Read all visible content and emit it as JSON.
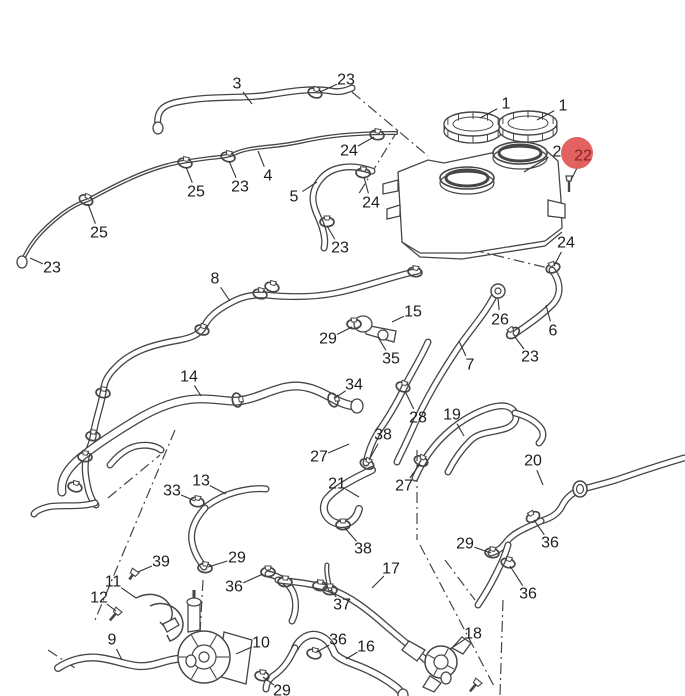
{
  "diagram": {
    "description": "exploded-parts-diagram-cooling-hoses",
    "background": "#ffffff",
    "line_color": "#464646",
    "label_color": "#1c1c1c",
    "highlight": {
      "fill": "#e05a5a",
      "text_color": "#8a1f1f",
      "radius": 16
    },
    "callouts": [
      {
        "label": "3",
        "x": 237,
        "y": 84,
        "tx": 252,
        "ty": 104
      },
      {
        "label": "23",
        "x": 346,
        "y": 80,
        "tx": 320,
        "ty": 92
      },
      {
        "label": "1",
        "x": 506,
        "y": 104,
        "tx": 480,
        "ty": 118
      },
      {
        "label": "1",
        "x": 563,
        "y": 106,
        "tx": 537,
        "ty": 120
      },
      {
        "label": "2",
        "x": 557,
        "y": 152,
        "tx": 524,
        "ty": 172
      },
      {
        "label": "22",
        "x": 583,
        "y": 156,
        "tx": 571,
        "ty": 180,
        "highlighted": true
      },
      {
        "label": "24",
        "x": 349,
        "y": 151,
        "tx": 374,
        "ty": 137
      },
      {
        "label": "25",
        "x": 196,
        "y": 192,
        "tx": 186,
        "ty": 167
      },
      {
        "label": "23",
        "x": 240,
        "y": 187,
        "tx": 229,
        "ty": 161
      },
      {
        "label": "4",
        "x": 268,
        "y": 176,
        "tx": 258,
        "ty": 151
      },
      {
        "label": "5",
        "x": 294,
        "y": 197,
        "tx": 317,
        "ty": 182
      },
      {
        "label": "24",
        "x": 371,
        "y": 203,
        "tx": 364,
        "ty": 177
      },
      {
        "label": "23",
        "x": 340,
        "y": 248,
        "tx": 327,
        "ty": 226
      },
      {
        "label": "25",
        "x": 99,
        "y": 233,
        "tx": 88,
        "ty": 204
      },
      {
        "label": "23",
        "x": 52,
        "y": 268,
        "tx": 30,
        "ty": 258
      },
      {
        "label": "24",
        "x": 566,
        "y": 243,
        "tx": 554,
        "ty": 266
      },
      {
        "label": "8",
        "x": 215,
        "y": 279,
        "tx": 230,
        "ty": 301
      },
      {
        "label": "26",
        "x": 500,
        "y": 320,
        "tx": 498,
        "ty": 298
      },
      {
        "label": "6",
        "x": 553,
        "y": 331,
        "tx": 546,
        "ty": 305
      },
      {
        "label": "23",
        "x": 530,
        "y": 357,
        "tx": 515,
        "ty": 337
      },
      {
        "label": "15",
        "x": 413,
        "y": 312,
        "tx": 392,
        "ty": 322
      },
      {
        "label": "29",
        "x": 328,
        "y": 339,
        "tx": 352,
        "ty": 327
      },
      {
        "label": "35",
        "x": 391,
        "y": 359,
        "tx": 378,
        "ty": 337
      },
      {
        "label": "7",
        "x": 470,
        "y": 365,
        "tx": 459,
        "ty": 341
      },
      {
        "label": "14",
        "x": 189,
        "y": 377,
        "tx": 201,
        "ty": 396
      },
      {
        "label": "34",
        "x": 354,
        "y": 385,
        "tx": 335,
        "ty": 398
      },
      {
        "label": "28",
        "x": 418,
        "y": 418,
        "tx": 405,
        "ty": 391
      },
      {
        "label": "38",
        "x": 383,
        "y": 435,
        "tx": 369,
        "ty": 460
      },
      {
        "label": "19",
        "x": 452,
        "y": 415,
        "tx": 464,
        "ty": 436
      },
      {
        "label": "27",
        "x": 319,
        "y": 457,
        "tx": 349,
        "ty": 444
      },
      {
        "label": "21",
        "x": 337,
        "y": 484,
        "tx": 359,
        "ty": 497
      },
      {
        "label": "27",
        "x": 404,
        "y": 486,
        "tx": 420,
        "ty": 464
      },
      {
        "label": "20",
        "x": 533,
        "y": 461,
        "tx": 543,
        "ty": 485
      },
      {
        "label": "36",
        "x": 550,
        "y": 543,
        "tx": 534,
        "ty": 520
      },
      {
        "label": "29",
        "x": 465,
        "y": 544,
        "tx": 491,
        "ty": 553
      },
      {
        "label": "36",
        "x": 528,
        "y": 594,
        "tx": 510,
        "ty": 566
      },
      {
        "label": "38",
        "x": 363,
        "y": 549,
        "tx": 345,
        "ty": 528
      },
      {
        "label": "17",
        "x": 391,
        "y": 569,
        "tx": 372,
        "ty": 588
      },
      {
        "label": "33",
        "x": 172,
        "y": 491,
        "tx": 195,
        "ty": 501
      },
      {
        "label": "13",
        "x": 201,
        "y": 481,
        "tx": 226,
        "ty": 494
      },
      {
        "label": "29",
        "x": 237,
        "y": 558,
        "tx": 208,
        "ty": 567
      },
      {
        "label": "36",
        "x": 234,
        "y": 587,
        "tx": 263,
        "ty": 574
      },
      {
        "label": "39",
        "x": 161,
        "y": 562,
        "tx": 138,
        "ty": 572
      },
      {
        "label": "11",
        "x": 113,
        "y": 582,
        "tx": 136,
        "ty": 598
      },
      {
        "label": "12",
        "x": 99,
        "y": 598,
        "tx": 116,
        "ty": 611
      },
      {
        "label": "9",
        "x": 112,
        "y": 640,
        "tx": 122,
        "ty": 660
      },
      {
        "label": "10",
        "x": 261,
        "y": 643,
        "tx": 236,
        "ty": 654
      },
      {
        "label": "37",
        "x": 342,
        "y": 605,
        "tx": 331,
        "ty": 590
      },
      {
        "label": "36",
        "x": 338,
        "y": 640,
        "tx": 317,
        "ty": 652
      },
      {
        "label": "16",
        "x": 366,
        "y": 647,
        "tx": 346,
        "ty": 659
      },
      {
        "label": "29",
        "x": 282,
        "y": 691,
        "tx": 263,
        "ty": 677
      },
      {
        "label": "18",
        "x": 473,
        "y": 634,
        "tx": 450,
        "ty": 649
      }
    ]
  }
}
